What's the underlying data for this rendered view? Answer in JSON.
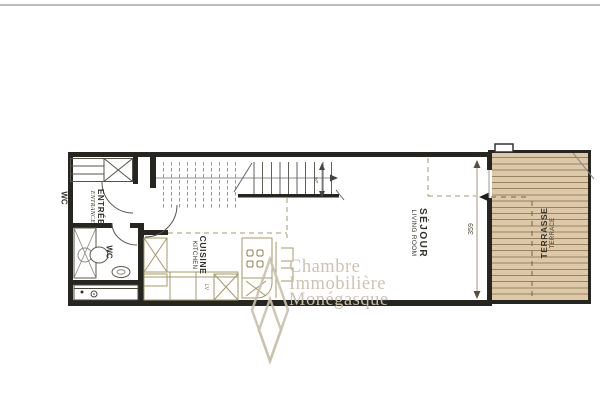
{
  "plan": {
    "labels": {
      "wc_side": "WC",
      "entree": {
        "fr": "ENTRÉE",
        "en": "ENTRANCE"
      },
      "wc": "WC",
      "cuisine": {
        "fr": "CUISINE",
        "en": "KITCHEN"
      },
      "sejour": {
        "fr": "SÉJOUR",
        "en": "LIVING ROOM"
      },
      "terrasse": {
        "fr": "TERRASSE",
        "en": "TERRACE"
      }
    },
    "dimensions": {
      "sejour_length": "359",
      "stair": "24",
      "appliance": "LV"
    }
  },
  "watermark": {
    "line1": "Chambre",
    "line2": "Immobilière",
    "line3": "Monégasque",
    "logo": "diamond-logo"
  },
  "colors": {
    "background": "#ffffff",
    "wall": "#26251f",
    "thin_line": "#55534a",
    "furniture_tan": "#a39a68",
    "terrace_bg": "#ddc9a9",
    "deck_line": "#99825f",
    "dimension": "#8a7d55",
    "watermark": "#c9c1ae"
  }
}
